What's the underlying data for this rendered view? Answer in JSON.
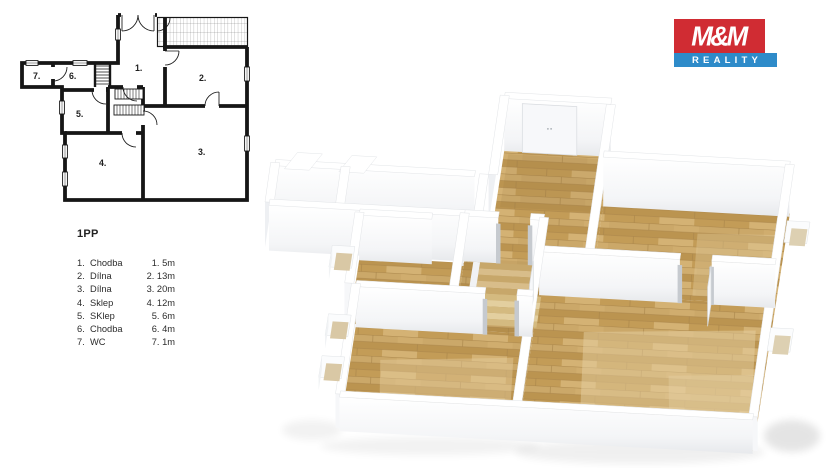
{
  "page": {
    "background": "#ffffff"
  },
  "plan": {
    "title": "1PP",
    "room_numbers": [
      "1.",
      "2.",
      "3.",
      "4.",
      "5.",
      "6.",
      "7."
    ],
    "legend": [
      {
        "num": "1.",
        "name": "Chodba",
        "size": "1. 5m"
      },
      {
        "num": "2.",
        "name": "Dílna",
        "size": "2. 13m"
      },
      {
        "num": "3.",
        "name": "Dílna",
        "size": "3. 20m"
      },
      {
        "num": "4.",
        "name": "Sklep",
        "size": "4. 12m"
      },
      {
        "num": "5.",
        "name": "SKlep",
        "size": "5. 6m"
      },
      {
        "num": "6.",
        "name": "Chodba",
        "size": "6. 4m"
      },
      {
        "num": "7.",
        "name": "WC",
        "size": "7. 1m"
      }
    ]
  },
  "logo": {
    "top": "M&M",
    "bottom": "REALITY",
    "red": "#d02c33",
    "blue": "#2e8bc9"
  },
  "colors": {
    "plan_line": "#161616",
    "wood": "#c5a05e",
    "wood_dark": "#b8914e",
    "wood_light": "#dcc391",
    "wall_white": "#ffffff",
    "wall_face": "#f6f7f9",
    "wall_side": "#eef0f3",
    "wc_floor": "#cbd0d3"
  }
}
